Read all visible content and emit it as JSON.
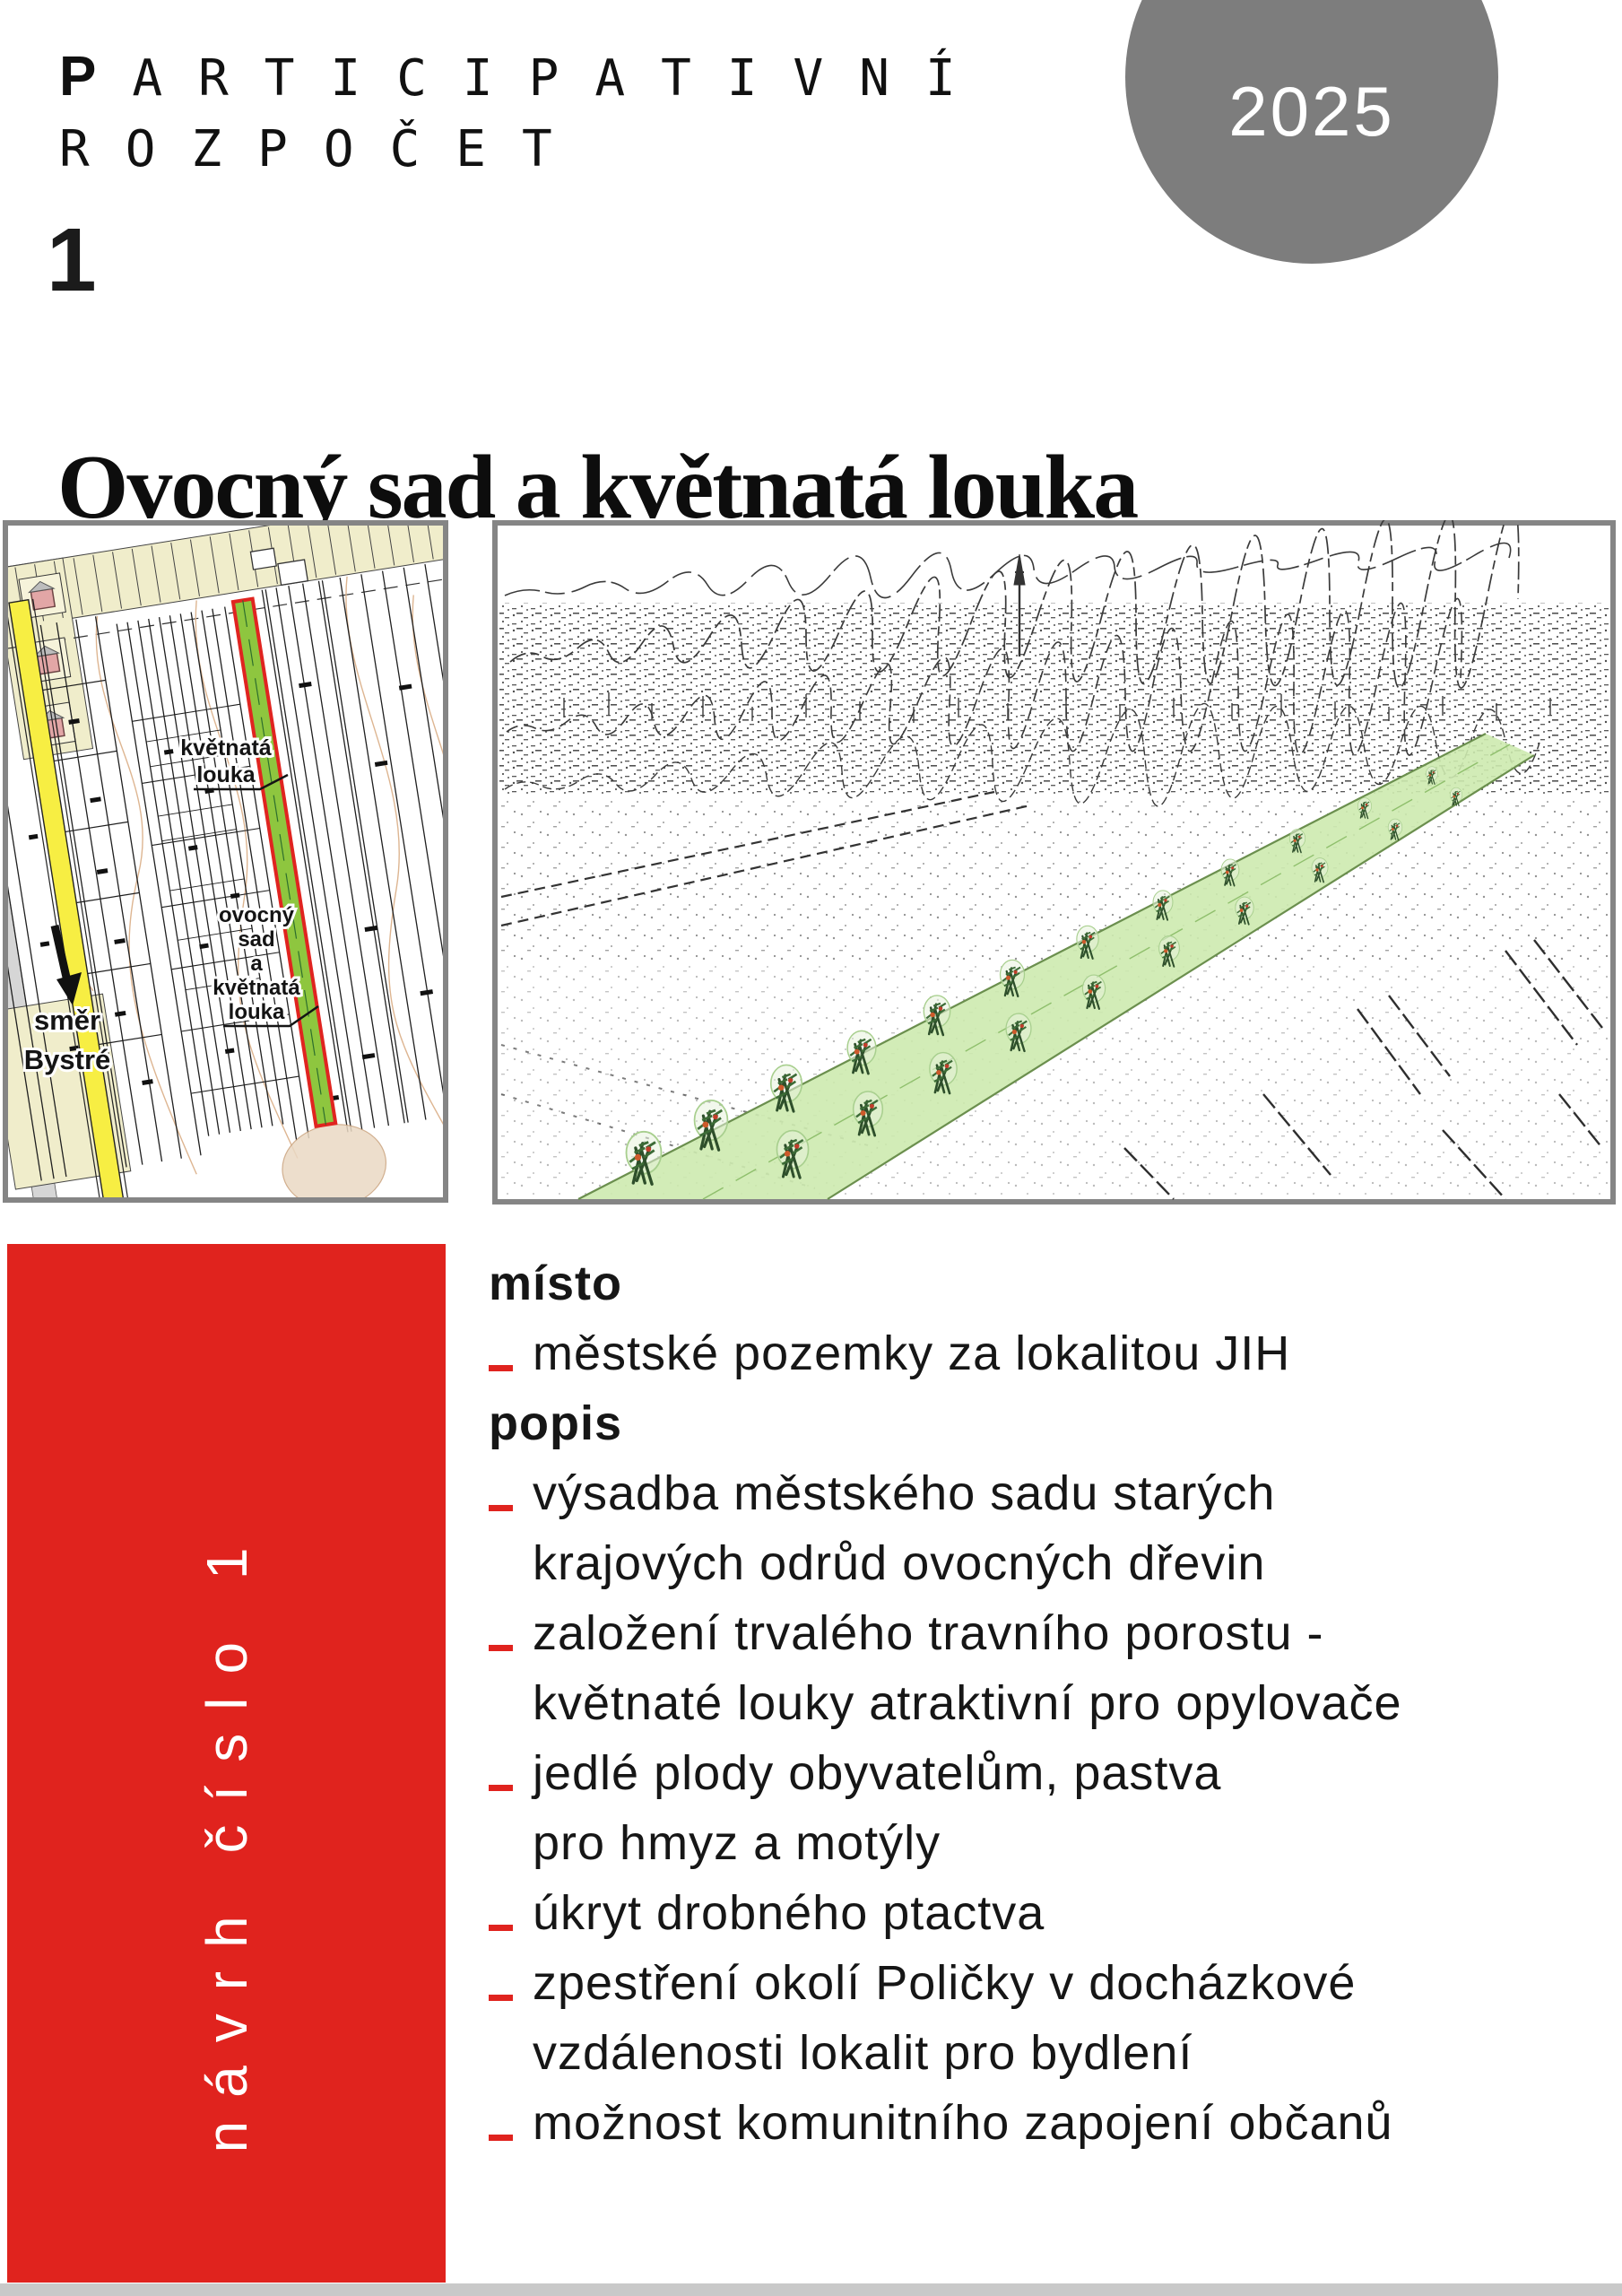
{
  "logo": {
    "initial": "P",
    "line1_rest": "ARTICIPATIVNÍ",
    "line2": "ROZPOČET"
  },
  "year_badge": {
    "year": "2025"
  },
  "header": {
    "proposal_number": "1",
    "title": "Ovocný sad a květnatá louka"
  },
  "sidebar": {
    "vertical_label": "návrh číslo 1"
  },
  "map": {
    "labels": {
      "meadow_line1": "květnatá",
      "meadow_line2": "louka",
      "orchard_lines": [
        "ovocný",
        "sad",
        "a",
        "květnatá",
        "louka"
      ],
      "direction_line1": "směr",
      "direction_line2": "Bystré"
    }
  },
  "rows": [
    {
      "style": "heading",
      "text": "místo"
    },
    {
      "style": "item",
      "text": "městské pozemky za lokalitou JIH"
    },
    {
      "style": "heading",
      "text": "popis"
    },
    {
      "style": "item",
      "text": "výsadba městského sadu starých"
    },
    {
      "style": "cont",
      "text": "krajových odrůd ovocných dřevin"
    },
    {
      "style": "item",
      "text": "založení trvalého travního porostu -"
    },
    {
      "style": "cont",
      "text": "květnaté louky atraktivní pro opylovače"
    },
    {
      "style": "item",
      "text": "jedlé plody obyvatelům, pastva"
    },
    {
      "style": "cont",
      "text": "pro hmyz a motýly"
    },
    {
      "style": "item",
      "text": "úkryt drobného ptactva"
    },
    {
      "style": "item",
      "text": "zpestření okolí Poličky v docházkové"
    },
    {
      "style": "cont",
      "text": "vzdálenosti lokalit pro bydlení"
    },
    {
      "style": "item",
      "text": "možnost komunitního zapojení občanů"
    }
  ],
  "colors": {
    "accent_red": "#e0231e",
    "badge_gray": "#7d7d7d",
    "map_road_yellow": "#f7ee43",
    "map_strip_green": "#8ec63f",
    "map_strip_outline_red": "#e02420",
    "map_parcel_cream": "#f0edcb",
    "sketch_strip_green": "#cdeaaf",
    "text_black": "#161616"
  }
}
